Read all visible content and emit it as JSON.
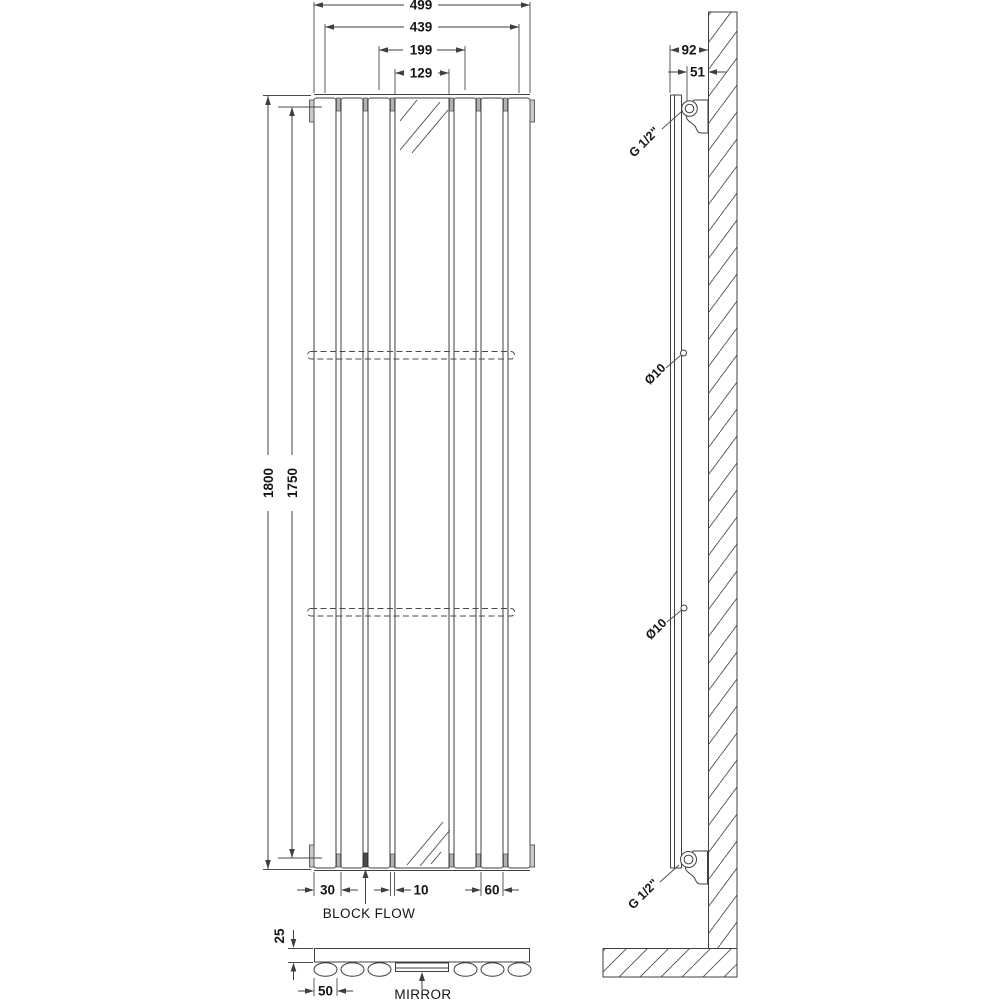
{
  "title": "Vertical mirror radiator technical drawing",
  "front_view": {
    "dim_overall_width": "499",
    "dim_centers_width": "439",
    "dim_mirror_frame": "199",
    "dim_mirror_glass": "129",
    "dim_overall_height": "1800",
    "dim_fixing_height": "1750",
    "dim_panel": "30",
    "dim_gap": "10",
    "dim_panel_pitch": "60",
    "label_block_flow": "BLOCK FLOW"
  },
  "side_view": {
    "dim_depth": "92",
    "dim_wall_to_connection": "51",
    "label_connection_top": "G 1/2\"",
    "label_fixing_upper": "Ø10",
    "label_fixing_lower": "Ø10",
    "label_connection_bottom": "G 1/2\""
  },
  "plan_view": {
    "dim_panel_depth": "25",
    "dim_oval_width": "50",
    "label_mirror": "MIRROR"
  }
}
